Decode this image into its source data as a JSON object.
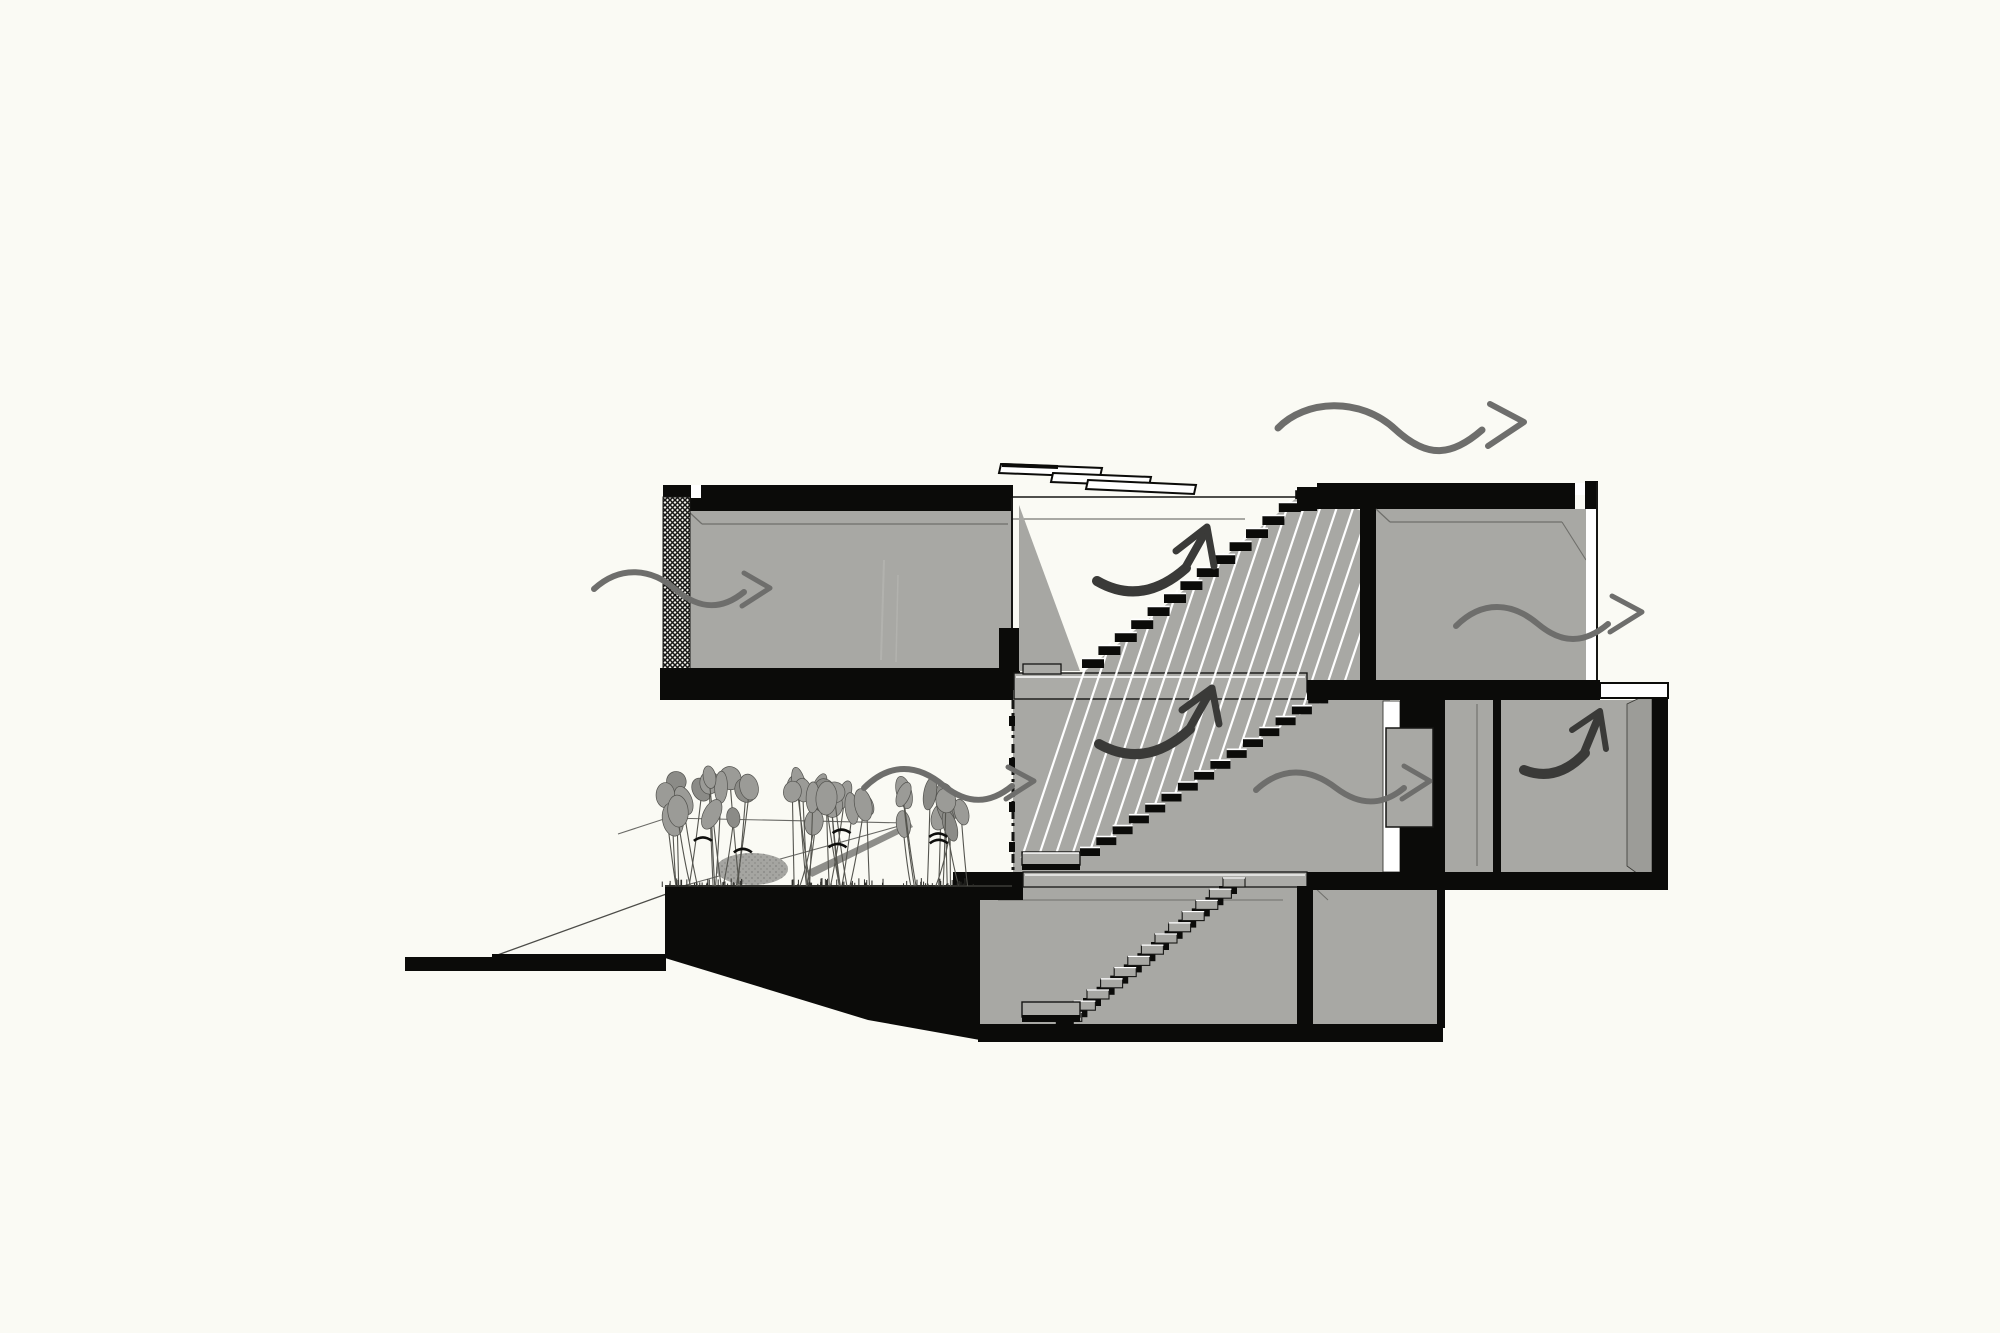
{
  "title": "architectural-section-ventilation-diagram",
  "colors": {
    "paper": "#fafaf4",
    "ink": "#0b0b09",
    "room_gray": "#a8a8a4",
    "face_gray": "#9c9c98",
    "slab_gray": "#ababa7",
    "wedge_gray": "#a7a7a3",
    "outline_dark": "#161614",
    "line_light": "#6f6f6b",
    "white": "#ffffff",
    "arrow_gray": "#6e6e6c",
    "arrow_dark": "#3a3a38",
    "leaf_gray": "#9b9b97",
    "leaf_dark": "#8b8b87",
    "stem_dark": "#55554f",
    "mound_gray": "#a5a5a1",
    "stipple_gray": "#83837f",
    "stick_gray": "#8e8e8a",
    "hatch_wall_bg": "#f2f1ec"
  },
  "stairs": {
    "upper_flight_steps": 14,
    "lower_flight_steps": 15,
    "basement_flight_steps": 13,
    "railing_hatch_lines": 22
  },
  "skylight": {
    "slat_count": 3
  },
  "plants": {
    "clusters": [
      {
        "cx": 705,
        "half_w": 44,
        "base_y": 886,
        "top_y": 782,
        "stems": 14,
        "seed": 11
      },
      {
        "cx": 836,
        "half_w": 50,
        "base_y": 886,
        "top_y": 792,
        "stems": 16,
        "seed": 29
      },
      {
        "cx": 936,
        "half_w": 38,
        "base_y": 886,
        "top_y": 800,
        "stems": 11,
        "seed": 47
      }
    ],
    "has_shrub_mound": true
  },
  "arrows": [
    {
      "name": "airflow-arrow-roof-exit",
      "type": "wavy",
      "color": "arrow_gray",
      "w": 7,
      "d": "M1278,428 C1305,400 1360,396 1396,430 C1428,459 1452,456 1482,430",
      "head": [
        [
          1524,
          422
        ],
        [
          1490,
          404
        ],
        [
          1488,
          446
        ]
      ],
      "hw": 6
    },
    {
      "name": "airflow-arrow-left-inlet",
      "type": "wavy",
      "color": "arrow_gray",
      "w": 6,
      "d": "M594,589 C620,565 652,568 676,590 C700,610 722,610 744,592",
      "head": [
        [
          770,
          588
        ],
        [
          744,
          573
        ],
        [
          742,
          606
        ]
      ],
      "hw": 5
    },
    {
      "name": "airflow-arrow-courtyard-inlet",
      "type": "wavy",
      "color": "arrow_gray",
      "w": 6,
      "d": "M864,788 C890,762 918,764 944,786 C968,805 990,804 1012,786",
      "head": [
        [
          1034,
          781
        ],
        [
          1008,
          767
        ],
        [
          1006,
          799
        ]
      ],
      "hw": 5
    },
    {
      "name": "airflow-arrow-upper-right-outlet",
      "type": "wavy",
      "color": "arrow_gray",
      "w": 6,
      "d": "M1456,626 C1482,600 1512,602 1538,624 C1562,644 1584,644 1608,624",
      "head": [
        [
          1642,
          612
        ],
        [
          1612,
          596
        ],
        [
          1610,
          632
        ]
      ],
      "hw": 5
    },
    {
      "name": "airflow-arrow-mid-door",
      "type": "wavy",
      "color": "arrow_gray",
      "w": 6,
      "d": "M1256,790 C1282,766 1310,768 1336,788 C1360,806 1382,806 1404,788",
      "head": [
        [
          1430,
          781
        ],
        [
          1404,
          766
        ],
        [
          1402,
          799
        ]
      ],
      "hw": 5
    },
    {
      "name": "airflow-arrow-stairwell-upper",
      "type": "swoosh",
      "color": "arrow_dark",
      "crescent": "M1097,581 Q1142,607 1186,568",
      "limb": "M1184,570 L1206,531",
      "head": [
        [
          1207,
          527
        ],
        [
          1176,
          551
        ],
        [
          1214,
          566
        ]
      ],
      "hw": 7
    },
    {
      "name": "airflow-arrow-stairwell-lower",
      "type": "swoosh",
      "color": "arrow_dark",
      "crescent": "M1099,744 Q1146,770 1190,729",
      "limb": "M1188,731 L1210,692",
      "head": [
        [
          1212,
          688
        ],
        [
          1182,
          710
        ],
        [
          1219,
          724
        ]
      ],
      "hw": 7
    },
    {
      "name": "airflow-arrow-basement-room",
      "type": "swoosh",
      "color": "arrow_dark",
      "crescent": "M1524,770 Q1557,783 1585,753",
      "limb": "M1583,755 L1599,716",
      "head": [
        [
          1600,
          711
        ],
        [
          1572,
          730
        ],
        [
          1606,
          749
        ]
      ],
      "hw": 6
    }
  ]
}
